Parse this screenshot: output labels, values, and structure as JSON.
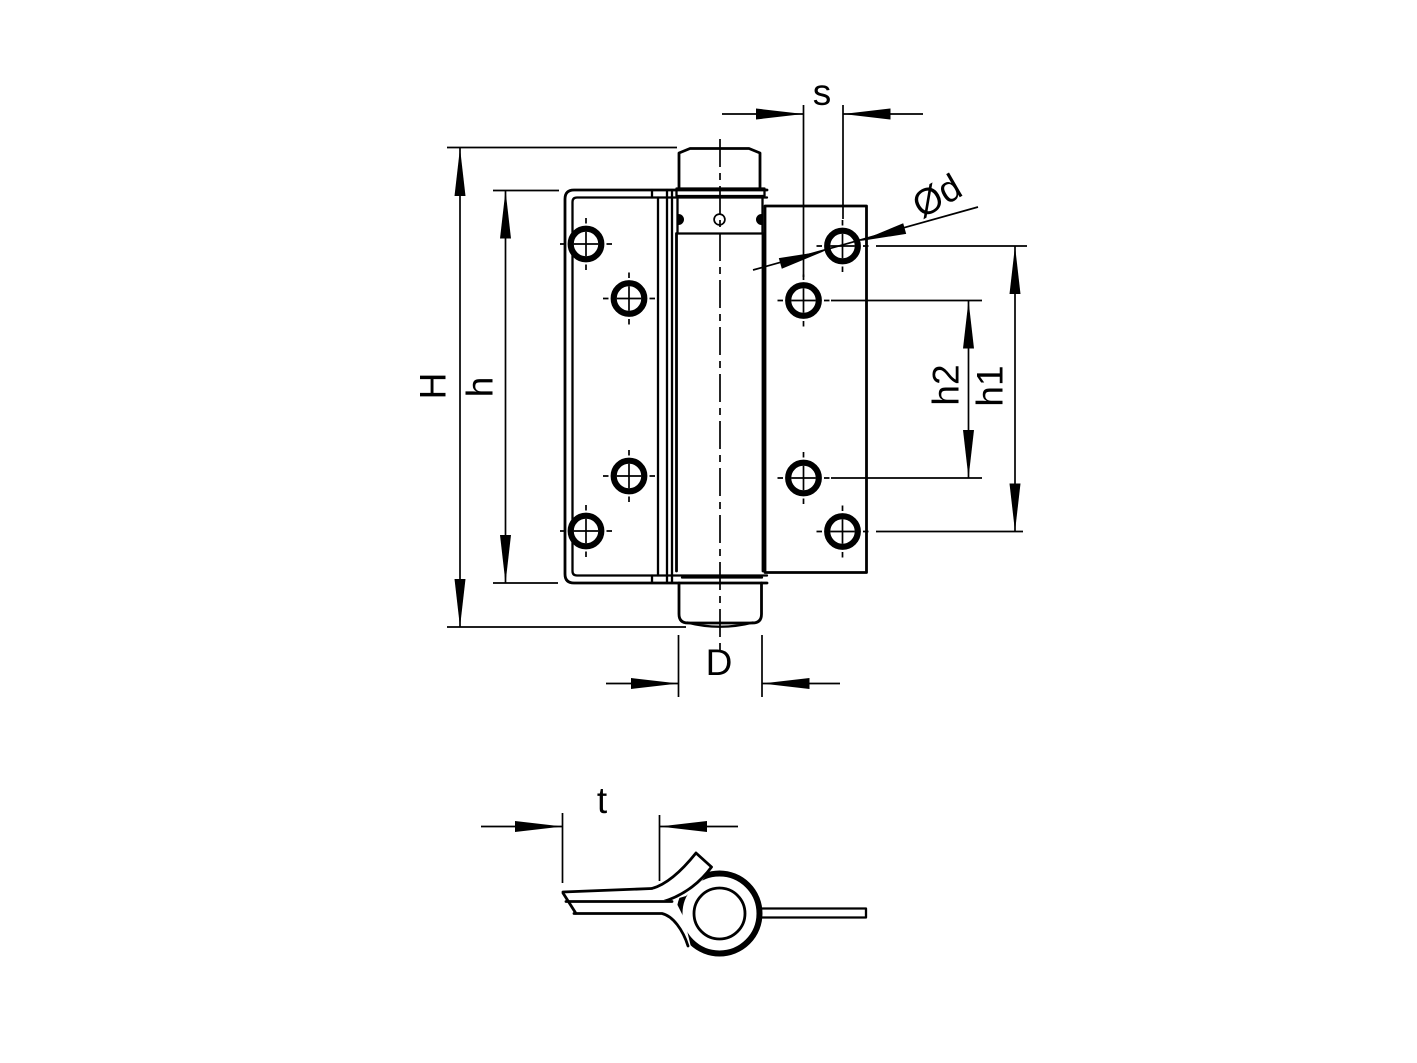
{
  "drawing": {
    "type": "technical-drawing",
    "subject": "single-action spring hinge, front view and leaf cross-section view",
    "colors": {
      "line": "#000000",
      "background": "#ffffff"
    },
    "labels": {
      "overall_height": "H",
      "leaf_height": "h",
      "gap": "s",
      "hole_diameter": "Ød",
      "hole_pitch_outer": "h1",
      "hole_pitch_inner": "h2",
      "barrel_diameter": "D",
      "leaf_thickness": "t"
    }
  }
}
